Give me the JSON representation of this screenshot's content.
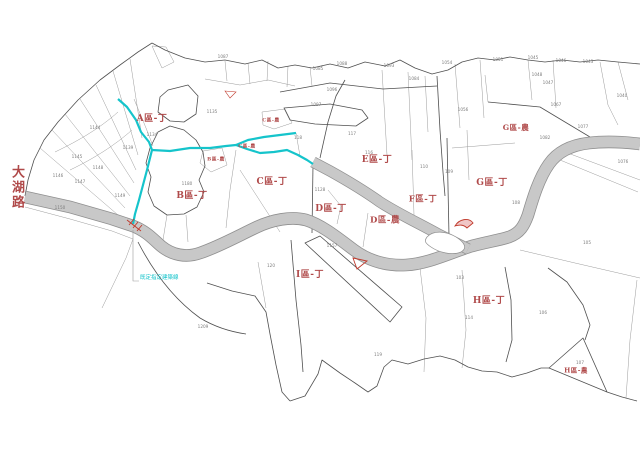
{
  "map": {
    "road_name": "大湖路",
    "building_line_label": "既定指定建築線",
    "colors": {
      "zone_label_red": "#b04a4a",
      "stream_cyan": "#15c4cb",
      "road_fill": "#c8c8c8",
      "road_edge": "#8f8f8f",
      "parcel_line_gray": "#9b9b9b",
      "boundary_dark": "#4f4f4f"
    },
    "zones": [
      {
        "id": "a-ding",
        "text": "A區-丁",
        "x": 152,
        "y": 120,
        "size": 9
      },
      {
        "id": "b-ding",
        "text": "B區-丁",
        "x": 192,
        "y": 197,
        "size": 9
      },
      {
        "id": "c-ding",
        "text": "C區-丁",
        "x": 272,
        "y": 183,
        "size": 9
      },
      {
        "id": "d-ding",
        "text": "D區-丁",
        "x": 331,
        "y": 210,
        "size": 9
      },
      {
        "id": "d-nong",
        "text": "D區-農",
        "x": 385,
        "y": 221,
        "size": 8.5
      },
      {
        "id": "e-ding",
        "text": "E區-丁",
        "x": 377,
        "y": 161,
        "size": 9
      },
      {
        "id": "f-ding",
        "text": "F區-丁",
        "x": 423,
        "y": 200,
        "size": 8.5
      },
      {
        "id": "g-ding",
        "text": "G區-丁",
        "x": 492,
        "y": 184,
        "size": 9
      },
      {
        "id": "g-nong",
        "text": "G區-農",
        "x": 516,
        "y": 128,
        "size": 7.5
      },
      {
        "id": "h-ding",
        "text": "H區-丁",
        "x": 489,
        "y": 302,
        "size": 9
      },
      {
        "id": "h-nong",
        "text": "H區-農",
        "x": 576,
        "y": 371,
        "size": 6.5
      },
      {
        "id": "i-ding",
        "text": "I區-丁",
        "x": 310,
        "y": 276,
        "size": 9
      },
      {
        "id": "c-nong-1",
        "text": "C區-農",
        "x": 271,
        "y": 121,
        "size": 4.8
      },
      {
        "id": "c-nong-2",
        "text": "C區-農",
        "x": 247,
        "y": 147,
        "size": 4.8
      },
      {
        "id": "b-nong",
        "text": "B區-農",
        "x": 216,
        "y": 160,
        "size": 4.8
      }
    ],
    "parcel_numbers": [
      {
        "x": 77,
        "y": 157,
        "t": "1145"
      },
      {
        "x": 58,
        "y": 176,
        "t": "1146"
      },
      {
        "x": 80,
        "y": 182,
        "t": "1147"
      },
      {
        "x": 98,
        "y": 168,
        "t": "1148"
      },
      {
        "x": 120,
        "y": 196,
        "t": "1149"
      },
      {
        "x": 60,
        "y": 208,
        "t": "1150"
      },
      {
        "x": 95,
        "y": 128,
        "t": "1144"
      },
      {
        "x": 152,
        "y": 135,
        "t": "1134"
      },
      {
        "x": 128,
        "y": 148,
        "t": "1139"
      },
      {
        "x": 212,
        "y": 112,
        "t": "1135"
      },
      {
        "x": 187,
        "y": 184,
        "t": "1180"
      },
      {
        "x": 223,
        "y": 57,
        "t": "1087"
      },
      {
        "x": 318,
        "y": 69,
        "t": "1085"
      },
      {
        "x": 342,
        "y": 64,
        "t": "1088"
      },
      {
        "x": 389,
        "y": 66,
        "t": "1093"
      },
      {
        "x": 414,
        "y": 79,
        "t": "1084"
      },
      {
        "x": 332,
        "y": 90,
        "t": "1096"
      },
      {
        "x": 316,
        "y": 105,
        "t": "1097"
      },
      {
        "x": 298,
        "y": 138,
        "t": "118"
      },
      {
        "x": 352,
        "y": 134,
        "t": "117"
      },
      {
        "x": 369,
        "y": 153,
        "t": "116"
      },
      {
        "x": 447,
        "y": 63,
        "t": "1054"
      },
      {
        "x": 498,
        "y": 60,
        "t": "1051"
      },
      {
        "x": 533,
        "y": 58,
        "t": "1045"
      },
      {
        "x": 561,
        "y": 61,
        "t": "1046"
      },
      {
        "x": 588,
        "y": 62,
        "t": "1043"
      },
      {
        "x": 537,
        "y": 75,
        "t": "1048"
      },
      {
        "x": 548,
        "y": 83,
        "t": "1047"
      },
      {
        "x": 556,
        "y": 105,
        "t": "1067"
      },
      {
        "x": 622,
        "y": 96,
        "t": "1040"
      },
      {
        "x": 463,
        "y": 110,
        "t": "1056"
      },
      {
        "x": 583,
        "y": 127,
        "t": "1077"
      },
      {
        "x": 545,
        "y": 138,
        "t": "1082"
      },
      {
        "x": 623,
        "y": 162,
        "t": "1076"
      },
      {
        "x": 424,
        "y": 167,
        "t": "110"
      },
      {
        "x": 449,
        "y": 172,
        "t": "109"
      },
      {
        "x": 516,
        "y": 203,
        "t": "108"
      },
      {
        "x": 587,
        "y": 243,
        "t": "105"
      },
      {
        "x": 460,
        "y": 278,
        "t": "103"
      },
      {
        "x": 469,
        "y": 318,
        "t": "114"
      },
      {
        "x": 543,
        "y": 313,
        "t": "106"
      },
      {
        "x": 580,
        "y": 363,
        "t": "107"
      },
      {
        "x": 378,
        "y": 355,
        "t": "119"
      },
      {
        "x": 271,
        "y": 266,
        "t": "120"
      },
      {
        "x": 203,
        "y": 327,
        "t": "1209"
      },
      {
        "x": 320,
        "y": 190,
        "t": "1128"
      },
      {
        "x": 332,
        "y": 246,
        "t": "1157"
      }
    ]
  }
}
